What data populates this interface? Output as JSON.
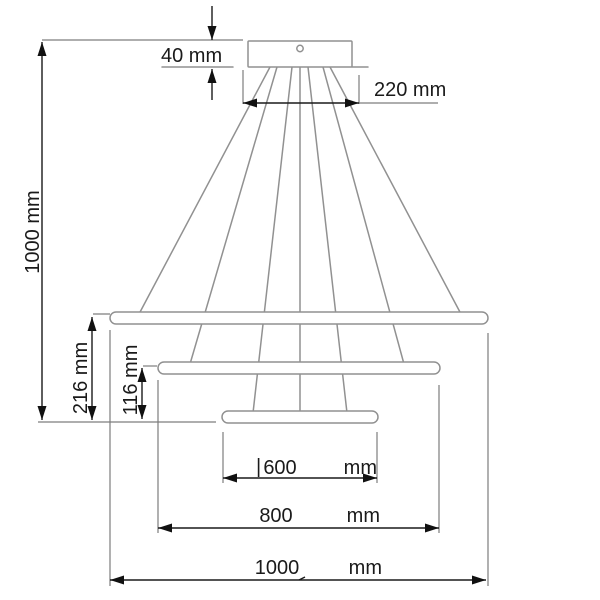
{
  "drawing": {
    "type": "technical-dimension-diagram",
    "subject": "three-ring pendant ceiling lamp, front elevation with dimension annotations",
    "background": "#ffffff",
    "line_colors": {
      "dimension": "#1a1a1a",
      "part_outline": "#919191",
      "extension": "#7d7d7d"
    },
    "dims": {
      "canopy_height": {
        "label": "40 mm",
        "value": "40",
        "unit": "mm"
      },
      "canopy_width": {
        "label": "220 mm",
        "value": "220",
        "unit": "mm"
      },
      "overall_height": {
        "label": "1000 mm",
        "value": "1000",
        "unit": "mm"
      },
      "drop_large_ring_to_bottom": {
        "label": "216 mm",
        "value": "216",
        "unit": "mm"
      },
      "drop_middle_ring_to_bottom": {
        "label": "116 mm",
        "value": "116",
        "unit": "mm"
      },
      "diameter_small_ring": {
        "prefix": "|",
        "value": "600",
        "unit": "mm"
      },
      "diameter_middle_ring": {
        "value": "800",
        "unit": "mm"
      },
      "diameter_large_ring": {
        "value": "1000",
        "unit": "mm"
      }
    }
  }
}
